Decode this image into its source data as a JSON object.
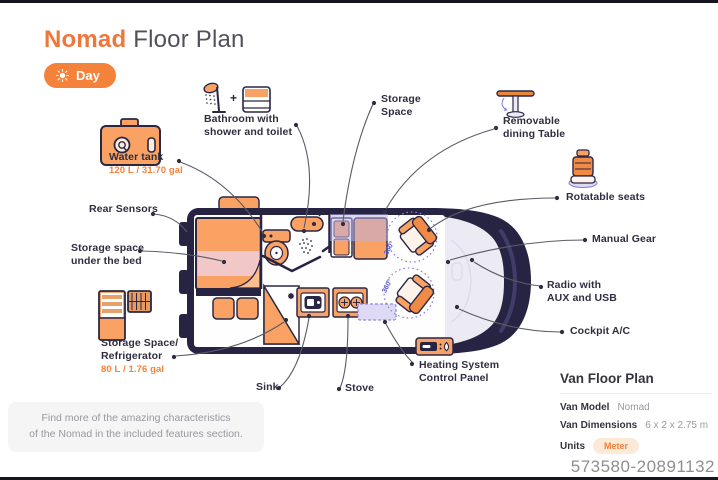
{
  "header": {
    "title_accent": "Nomad",
    "title_rest": "Floor Plan",
    "mode_label": "Day"
  },
  "labels": {
    "bathroom": {
      "line1": "Bathroom with",
      "line2": "shower and toilet"
    },
    "bathroom_plus": "+",
    "water_tank": {
      "line1": "Water tank",
      "value": "120 L / 31.70 gal"
    },
    "rear_sensors": {
      "line1": "Rear Sensors"
    },
    "storage_under_bed": {
      "line1": "Storage space",
      "line2": "under the bed"
    },
    "storage_refrigerator": {
      "line1": "Storage Space/",
      "line2": "Refrigerator",
      "value": "80 L / 1.76 gal"
    },
    "sink": {
      "line1": "Sink"
    },
    "stove": {
      "line1": "Stove"
    },
    "heating": {
      "line1": "Heating System",
      "line2": "Control Panel"
    },
    "storage_space": {
      "line1": "Storage",
      "line2": "Space"
    },
    "dining_table": {
      "line1": "Removable",
      "line2": "dining Table"
    },
    "rotatable_seats": {
      "line1": "Rotatable seats"
    },
    "manual_gear": {
      "line1": "Manual Gear"
    },
    "radio": {
      "line1": "Radio with",
      "line2": "AUX and USB"
    },
    "cockpit_ac": {
      "line1": "Cockpit A/C"
    }
  },
  "plan": {
    "rotation_label": "360°"
  },
  "note": {
    "line1": "Find more of the amazing characteristics",
    "line2": "of the Nomad in the included features section."
  },
  "info_panel": {
    "title": "Van Floor Plan",
    "rows": [
      {
        "label": "Van Model",
        "value": "Nomad"
      },
      {
        "label": "Van Dimensions",
        "value": "6 x 2 x 2.75 m"
      },
      {
        "label": "Units",
        "value": "Meter"
      }
    ]
  },
  "watermark": "573580-20891132",
  "colors": {
    "accent_orange": "#F5823A",
    "furniture_orange": "#F9A264",
    "van_navy": "#262343",
    "bed_pink": "#F1C7C7",
    "storage_lavender": "#B7AFE8",
    "rotation_blue": "#5A5FD6",
    "label_dark": "#2F2E41"
  }
}
